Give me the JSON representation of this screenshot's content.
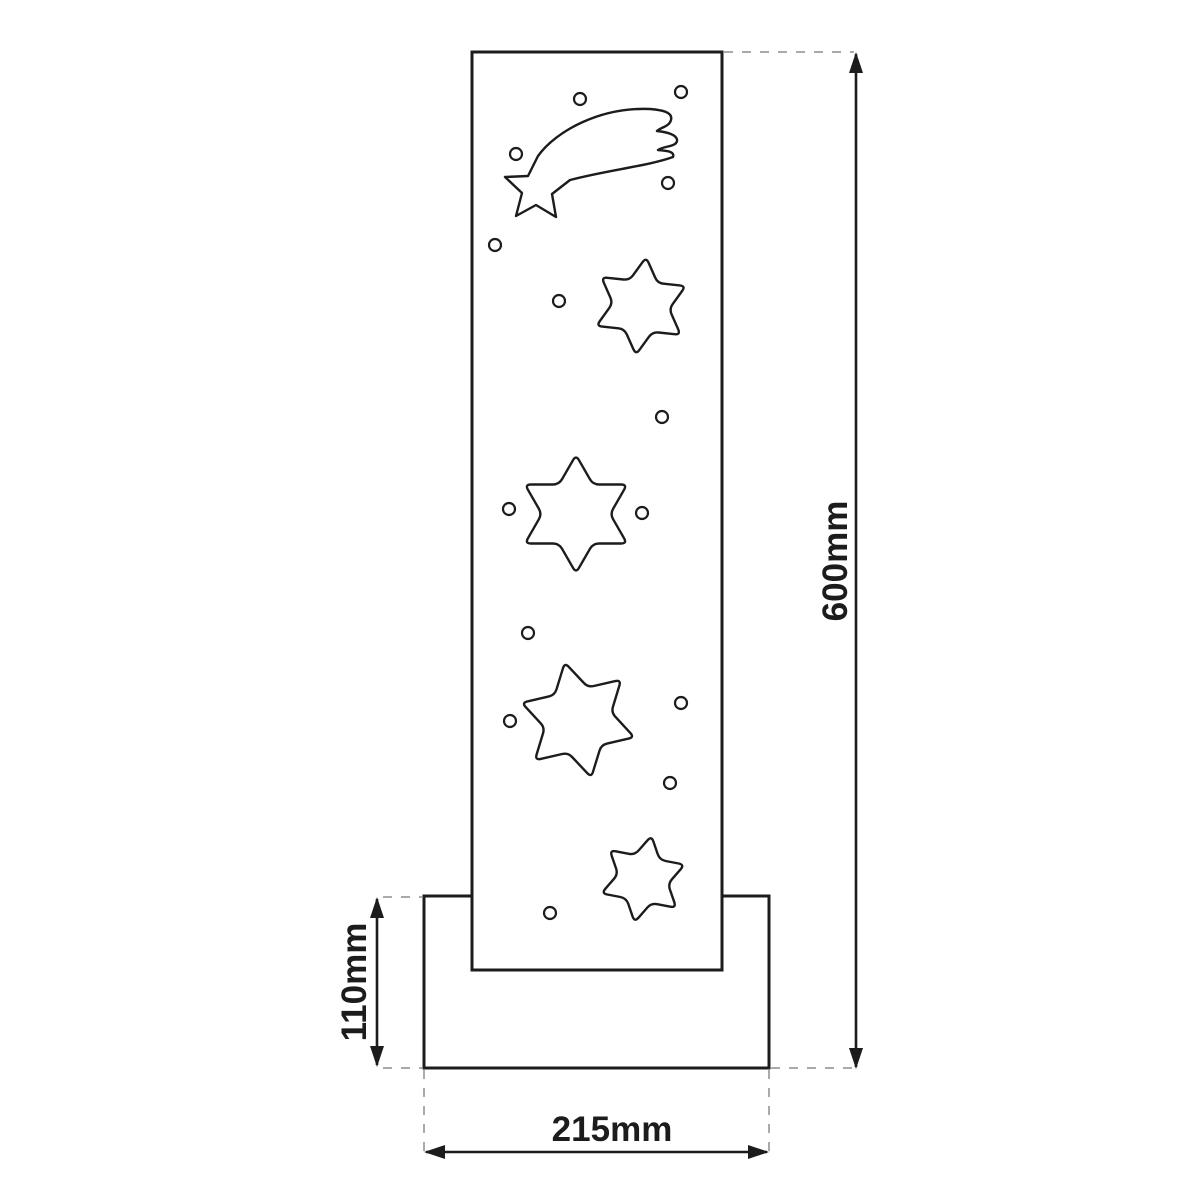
{
  "figure": {
    "title": "Star panel with base - dimension drawing",
    "background": "#ffffff",
    "line_color": "#1c1c1c",
    "guide_color": "#aaaaaa",
    "panel": {
      "x": 472,
      "y": 52,
      "w": 250,
      "h": 918,
      "stroke_w": 3
    },
    "base": {
      "x": 424,
      "y": 896,
      "w": 345,
      "h": 172,
      "stroke_w": 3
    },
    "comet_path": "M 538 156 C 556 131 600 107 650 109 C 662 110 673 112 671 120 C 669 127 661 127 657 131 C 667 132 678 135 677 141 C 676 147 663 146 658 150 C 666 151 675 151 673 157 C 648 166 608 170 570 180 L 552 194 L 556 217 L 536 205 L 516 216 L 522 193 L 505 177 L 528 176 Z",
    "comet_stroke_w": 2.4,
    "stars": [
      {
        "cx": 641,
        "cy": 306,
        "outer_r": 49,
        "rot": 6
      },
      {
        "cx": 576,
        "cy": 514,
        "outer_r": 59,
        "rot": 0
      },
      {
        "cx": 578,
        "cy": 720,
        "outer_r": 59,
        "rot": -13
      },
      {
        "cx": 643,
        "cy": 879,
        "outer_r": 44,
        "rot": 11
      }
    ],
    "star_inner_ratio": 0.578,
    "star_corner_r": 6,
    "star_stroke_w": 2.4,
    "holes": [
      {
        "cx": 580,
        "cy": 99
      },
      {
        "cx": 681,
        "cy": 92
      },
      {
        "cx": 516,
        "cy": 154
      },
      {
        "cx": 668,
        "cy": 183
      },
      {
        "cx": 495,
        "cy": 245
      },
      {
        "cx": 559,
        "cy": 301
      },
      {
        "cx": 662,
        "cy": 417
      },
      {
        "cx": 509,
        "cy": 509
      },
      {
        "cx": 642,
        "cy": 513
      },
      {
        "cx": 528,
        "cy": 633
      },
      {
        "cx": 681,
        "cy": 703
      },
      {
        "cx": 510,
        "cy": 721
      },
      {
        "cx": 670,
        "cy": 783
      },
      {
        "cx": 550,
        "cy": 913
      }
    ],
    "hole_r": 6,
    "hole_stroke_w": 2.2,
    "dimensions": [
      {
        "name": "total-height",
        "label": "600mm",
        "orient": "v",
        "x": 856,
        "y1": 52,
        "y2": 1069,
        "lx": 836,
        "ly": 561
      },
      {
        "name": "base-height",
        "label": "110mm",
        "orient": "v",
        "x": 377,
        "y1": 897,
        "y2": 1067,
        "lx": 355,
        "ly": 982
      },
      {
        "name": "base-width",
        "label": "215mm",
        "orient": "h",
        "y": 1152,
        "x1": 424,
        "x2": 769,
        "lx": 612,
        "ly": 1130
      }
    ],
    "dim_stroke_w": 2.6,
    "arrow_len": 21,
    "arrow_half_w": 7,
    "guides": [
      {
        "x1": 724,
        "y1": 52,
        "x2": 854,
        "y2": 52
      },
      {
        "x1": 383,
        "y1": 897,
        "x2": 422,
        "y2": 897
      },
      {
        "x1": 383,
        "y1": 1068,
        "x2": 422,
        "y2": 1068
      },
      {
        "x1": 771,
        "y1": 1068,
        "x2": 854,
        "y2": 1068
      },
      {
        "x1": 424,
        "y1": 1070,
        "x2": 424,
        "y2": 1156
      },
      {
        "x1": 769,
        "y1": 1070,
        "x2": 769,
        "y2": 1156
      }
    ],
    "guide_stroke_w": 2,
    "guide_dash": "9 9"
  }
}
